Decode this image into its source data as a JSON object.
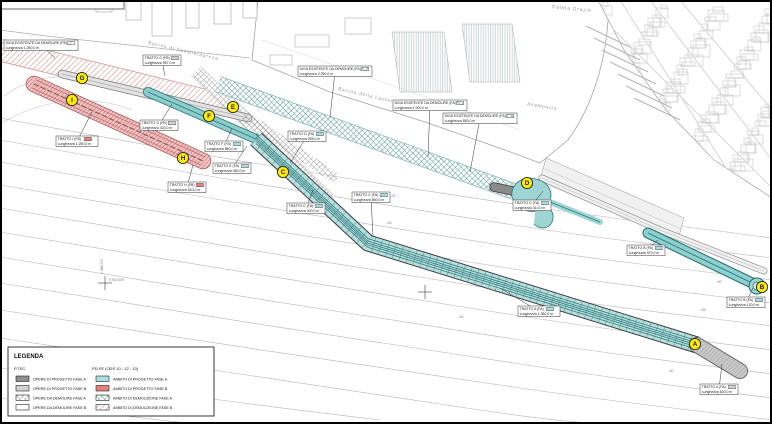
{
  "title": "Planimetria porto - fasi di progetto e demolizione",
  "colors": {
    "new_works_teal": "#9fd4d4",
    "new_works_teal_dark": "#2f7d7d",
    "phase_b_red": "#e87f7f",
    "demolition_pink": "#d89a9a",
    "existing_gray": "#d2d2d2",
    "dark_gray": "#8f8f8f",
    "marker_yellow": "#ffec00",
    "linework_gray": "#b5b5b5",
    "frame_black": "#000000"
  },
  "map": {
    "area_labels": [
      {
        "text": "Bacino di Sampierdarena",
        "x": 148,
        "y": 44,
        "rot": 13
      },
      {
        "text": "Bacino della Lanterna",
        "x": 338,
        "y": 90,
        "rot": 13
      },
      {
        "text": "Avamporto",
        "x": 527,
        "y": 105,
        "rot": 10
      },
      {
        "text": "Calata Grazie",
        "x": 552,
        "y": 8,
        "rot": 6
      }
    ],
    "depth_labels": [
      {
        "text": "-20",
        "x": 390,
        "y": 197
      },
      {
        "text": "-30",
        "x": 386,
        "y": 224
      },
      {
        "text": "-40",
        "x": 458,
        "y": 318
      },
      {
        "text": "-50",
        "x": 716,
        "y": 283
      },
      {
        "text": "-55",
        "x": 700,
        "y": 311
      },
      {
        "text": "-60",
        "x": 668,
        "y": 372
      }
    ],
    "section_markers": [
      {
        "letter": "A",
        "x": 695,
        "y": 344
      },
      {
        "letter": "B",
        "x": 762,
        "y": 287
      },
      {
        "letter": "C",
        "x": 283,
        "y": 172
      },
      {
        "letter": "D",
        "x": 527,
        "y": 183
      },
      {
        "letter": "E",
        "x": 233,
        "y": 107
      },
      {
        "letter": "F",
        "x": 209,
        "y": 116
      },
      {
        "letter": "G",
        "x": 82,
        "y": 78
      },
      {
        "letter": "H",
        "x": 183,
        "y": 158
      },
      {
        "letter": "I",
        "x": 72,
        "y": 100
      }
    ],
    "annotations": [
      {
        "x": 4,
        "y": 40,
        "tx": 55,
        "ty": 58,
        "line1": "DIGA ESISTENTE DA DEMOLIRE (FB)",
        "line2": "Lunghezza 1.250,0 m",
        "swatch": "hatch-pink"
      },
      {
        "x": 143,
        "y": 55,
        "tx": 165,
        "ty": 76,
        "line1": "TRATTO G (FB)",
        "line2": "Lunghezza 957,0 m",
        "swatch": "solid-gray"
      },
      {
        "x": 298,
        "y": 66,
        "tx": 330,
        "ty": 118,
        "line1": "DIGA ESISTENTE DA DEMOLIRE (FA)",
        "line2": "Lunghezza 2.250,0 m",
        "swatch": "hatch-teal"
      },
      {
        "x": 393,
        "y": 100,
        "tx": 428,
        "ty": 156,
        "line1": "DIGA ESISTENTE DA DEMOLIRE (FA)",
        "line2": "Lunghezza 1.000,0 m",
        "swatch": "hatch-teal"
      },
      {
        "x": 443,
        "y": 113,
        "tx": 470,
        "ty": 172,
        "line1": "DIGA ESISTENTE DA DEMOLIRE (FA)",
        "line2": "Lunghezza 850,0 m",
        "swatch": "hatch-teal"
      },
      {
        "x": 56,
        "y": 136,
        "tx": 92,
        "ty": 112,
        "line1": "TRATTO I (FB)",
        "line2": "Lunghezza 1.250,0 m",
        "swatch": "solid-red"
      },
      {
        "x": 140,
        "y": 120,
        "tx": 172,
        "ty": 104,
        "line1": "TRATTO G (FB)",
        "line2": "Lunghezza 420,0 m",
        "swatch": "solid-gray"
      },
      {
        "x": 205,
        "y": 141,
        "tx": 232,
        "ty": 128,
        "line1": "TRATTO F (FA)",
        "line2": "Lunghezza 880,0 m",
        "swatch": "solid-cyan"
      },
      {
        "x": 213,
        "y": 163,
        "tx": 247,
        "ty": 146,
        "line1": "TRATTO E (FA)",
        "line2": "Lunghezza 450,0 m",
        "swatch": "solid-cyan"
      },
      {
        "x": 168,
        "y": 182,
        "tx": 193,
        "ty": 165,
        "line1": "TRATTO H (FB)",
        "line2": "Lunghezza 620,0 m",
        "swatch": "solid-red"
      },
      {
        "x": 288,
        "y": 131,
        "tx": 290,
        "ty": 163,
        "line1": "TRATTO D (FA)",
        "line2": "Lunghezza 255,0 m",
        "swatch": "solid-cyan"
      },
      {
        "x": 287,
        "y": 203,
        "tx": 313,
        "ty": 190,
        "line1": "TRATTO C (FA)",
        "line2": "Lunghezza 400,0 m",
        "swatch": "solid-cyan"
      },
      {
        "x": 352,
        "y": 192,
        "tx": 373,
        "ty": 236,
        "line1": "TRATTO C (FA)",
        "line2": "Lunghezza 860,0 m",
        "swatch": "solid-cyan"
      },
      {
        "x": 513,
        "y": 200,
        "tx": 543,
        "ty": 191,
        "line1": "TRATTO D (FA)",
        "line2": "Lunghezza 310,0 m",
        "swatch": "solid-cyan"
      },
      {
        "x": 627,
        "y": 245,
        "tx": 658,
        "ty": 240,
        "line1": "TRATTO B (FA)",
        "line2": "Lunghezza 970,0 m",
        "swatch": "solid-cyan"
      },
      {
        "x": 727,
        "y": 297,
        "tx": 753,
        "ty": 288,
        "line1": "TRATTO B (FA)",
        "line2": "Lunghezza 120,0 m",
        "swatch": "solid-cyan"
      },
      {
        "x": 700,
        "y": 384,
        "tx": 722,
        "ty": 364,
        "line1": "TRATTO A (FA)",
        "line2": "Lunghezza 620,0 m",
        "swatch": "solid-gray"
      },
      {
        "x": 518,
        "y": 306,
        "tx": 500,
        "ty": 288,
        "line1": "TRATTO A (FA)",
        "line2": "Lunghezza 1.350,0 m",
        "swatch": "solid-cyan"
      }
    ],
    "coordinate_marks": [
      {
        "x": 105,
        "y": 283,
        "north_label": "4 910 000",
        "east_label": "1 488 000"
      },
      {
        "x": 425,
        "y": 292,
        "north_label": "",
        "east_label": ""
      }
    ]
  },
  "legend": {
    "title": "LEGENDA",
    "left": {
      "header": "P.TEC.",
      "items": [
        {
          "label": "OPERE DI PROGETTO FASE A",
          "swatch": "solid-darkgray"
        },
        {
          "label": "OPERE DI PROGETTO FASE B",
          "swatch": "solid-gray"
        },
        {
          "label": "OPERE DA DEMOLIRE FASE A",
          "swatch": "hatch-gray"
        },
        {
          "label": "OPERE DA DEMOLIRE FASE B",
          "swatch": "solid-white"
        }
      ]
    },
    "right": {
      "header": "PD-FE (ODS 10 - 12 - 13)",
      "items": [
        {
          "label": "AMBITO DI PROGETTO FASE A",
          "swatch": "solid-cyan"
        },
        {
          "label": "AMBITO DI PROGETTO FASE B",
          "swatch": "solid-red"
        },
        {
          "label": "AMBITO DI DEMOLIZIONE FASE A",
          "swatch": "hatch-teal"
        },
        {
          "label": "AMBITO DI DEMOLIZIONE FASE B",
          "swatch": "hatch-pink"
        }
      ]
    }
  }
}
